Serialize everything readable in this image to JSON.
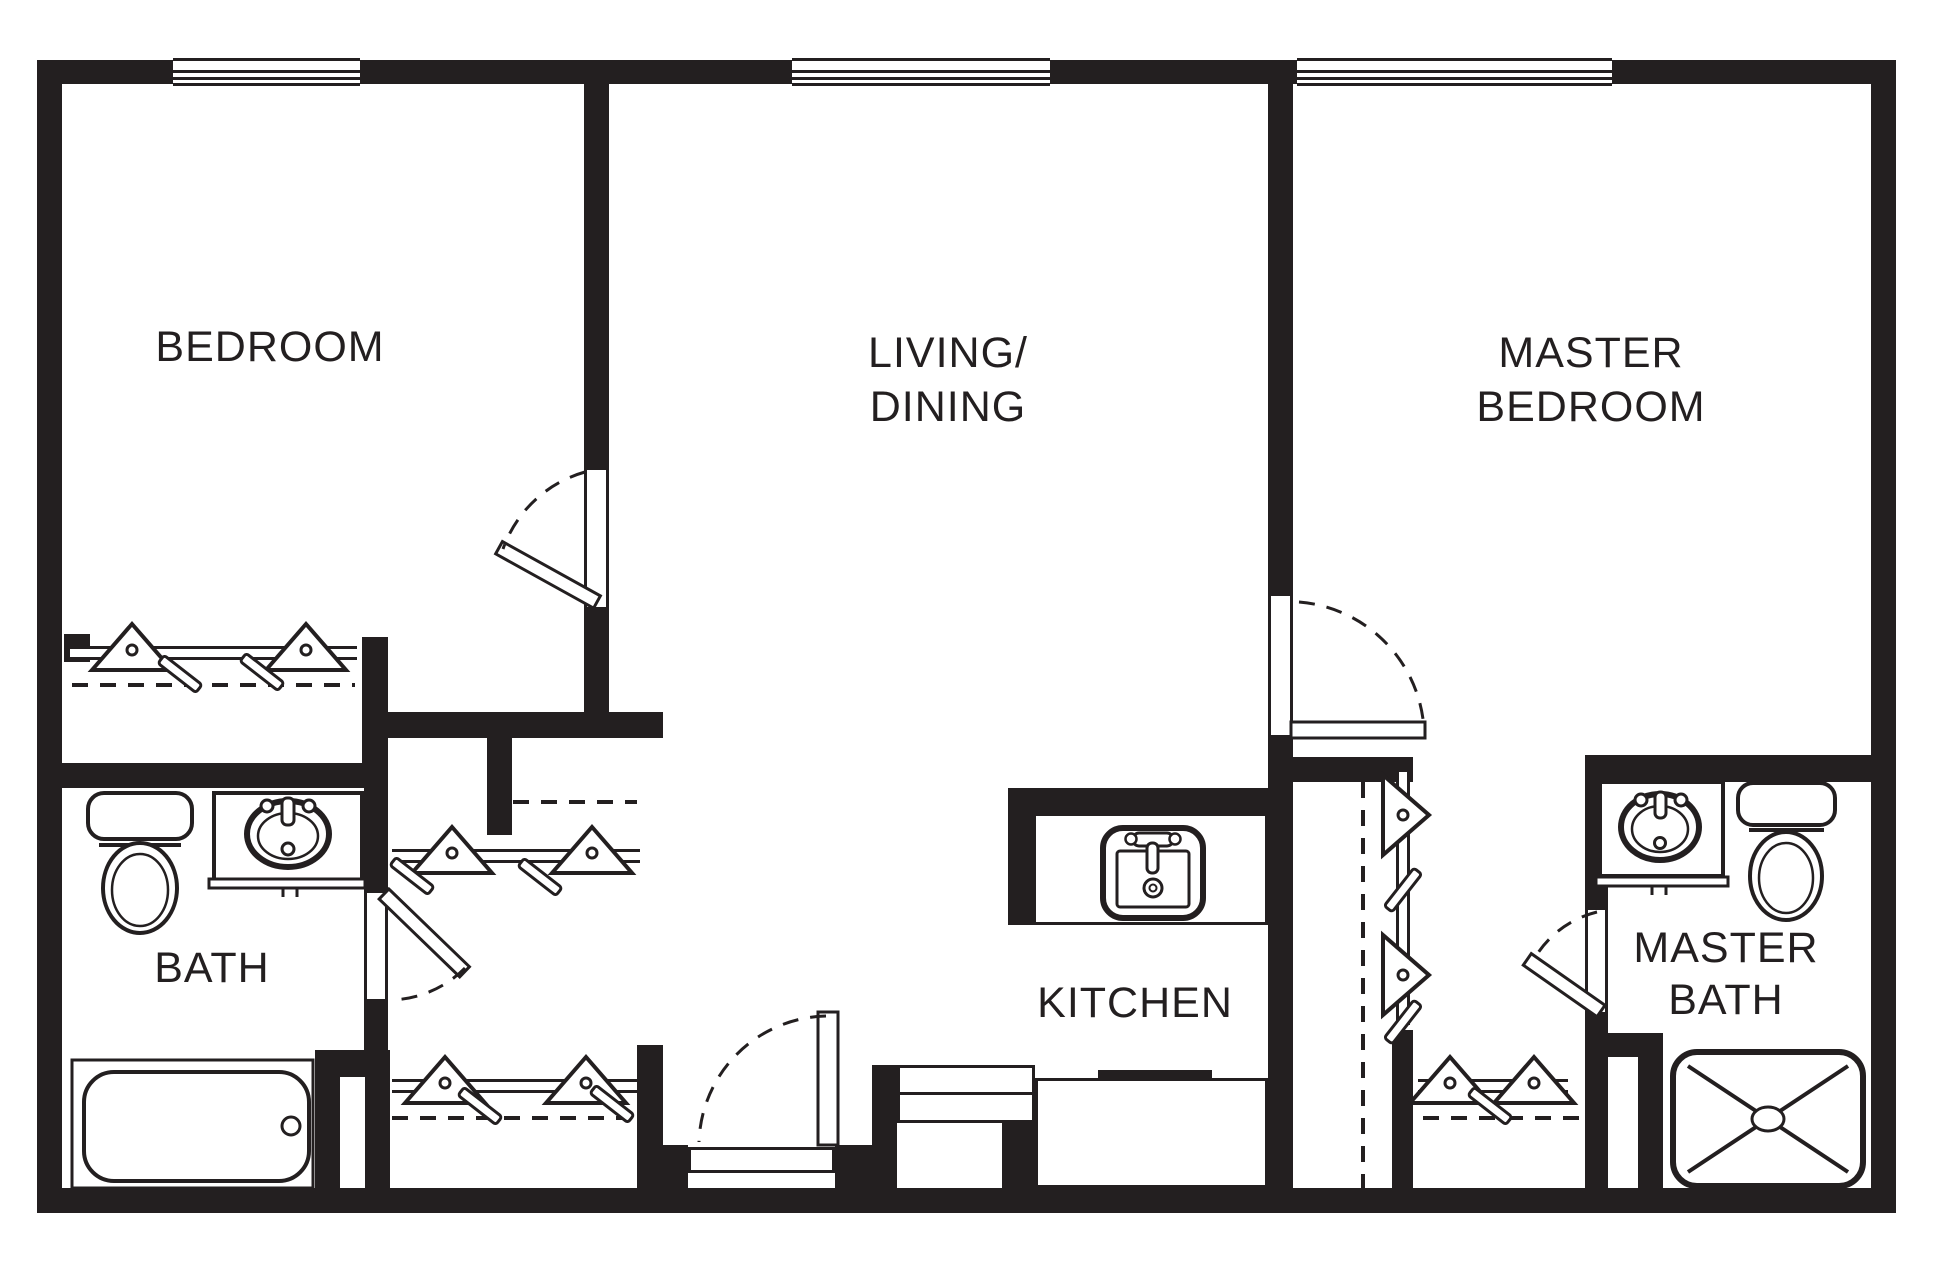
{
  "figure": {
    "type": "floor-plan",
    "background_color": "#ffffff",
    "line_color": "#231f20"
  },
  "rooms": {
    "bedroom": {
      "label": "BEDROOM"
    },
    "living_dining": {
      "line1": "LIVING/",
      "line2": "DINING"
    },
    "master_bedroom": {
      "line1": "MASTER",
      "line2": "BEDROOM"
    },
    "bath": {
      "label": "BATH"
    },
    "kitchen": {
      "label": "KITCHEN"
    },
    "master_bath": {
      "line1": "MASTER",
      "line2": "BATH"
    }
  },
  "symbols": {
    "window_count": 3,
    "door_count": 5,
    "fixture_icons": [
      "toilet-icon",
      "vanity-sink-icon",
      "bathtub-icon",
      "shower-icon",
      "kitchen-sink-icon",
      "closet-rod",
      "clothes-hanger-icon",
      "door-swing-icon",
      "window-symbol"
    ]
  }
}
